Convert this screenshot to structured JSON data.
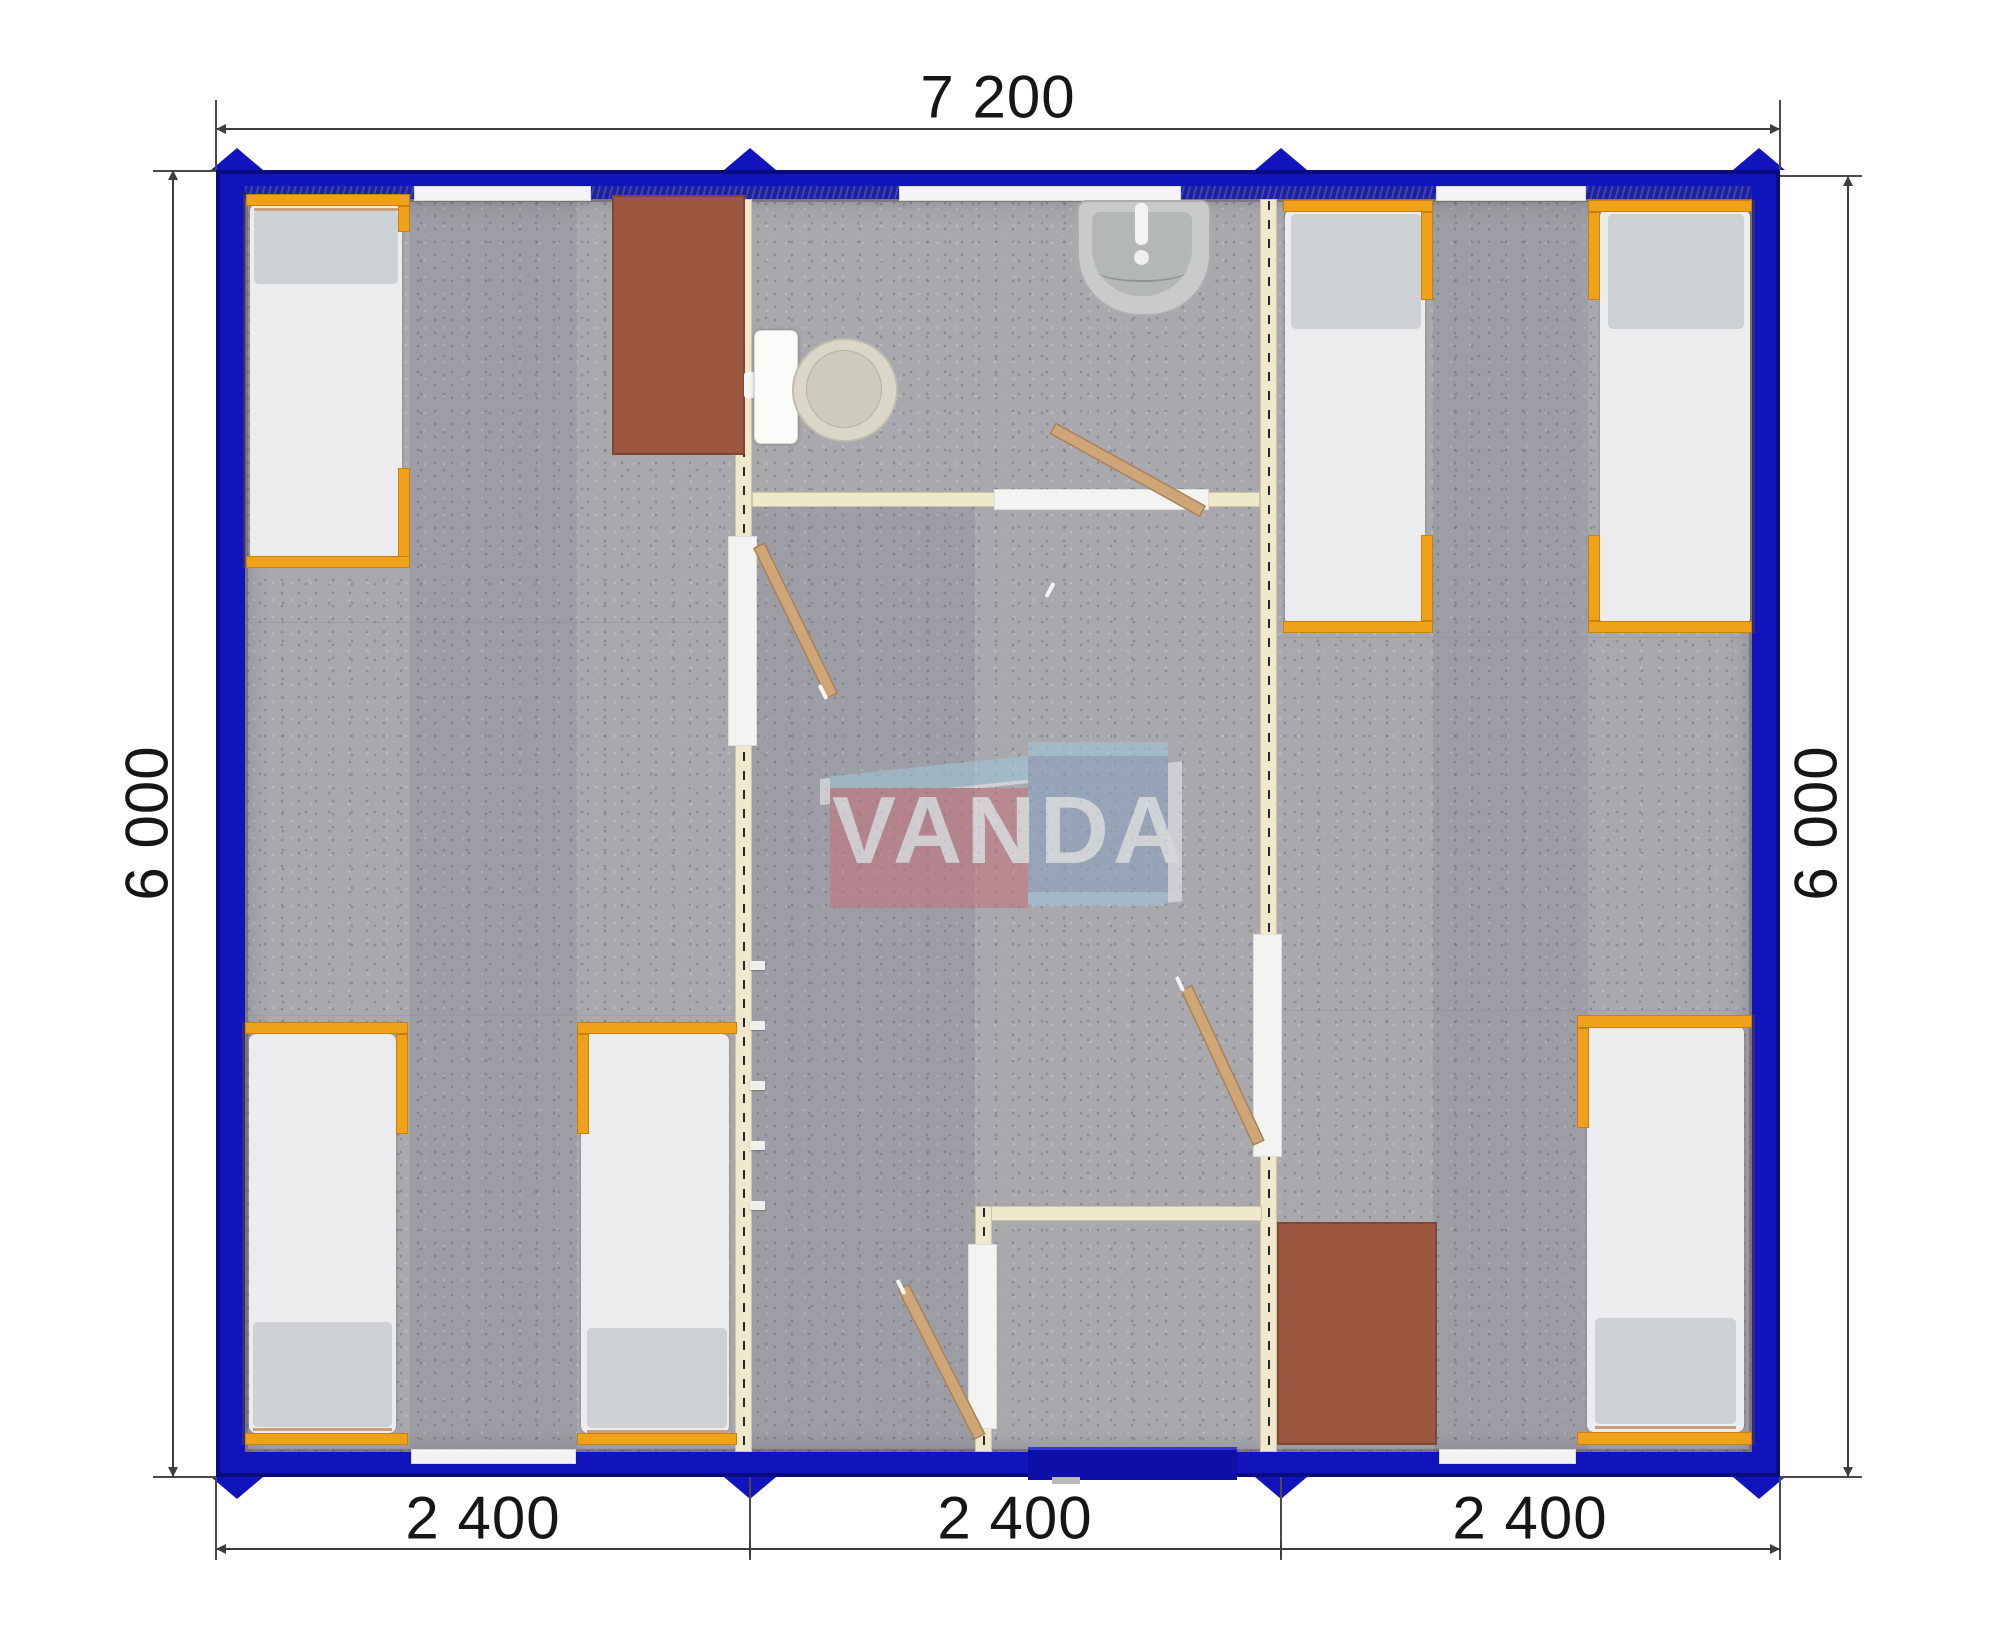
{
  "dimensions": {
    "top": "7 200",
    "left": "6 000",
    "right": "6 000",
    "bottom": [
      "2 400",
      "2 400",
      "2 400"
    ]
  },
  "logo": {
    "text": "VANDA"
  },
  "colors": {
    "wall_blue": "#1114bd",
    "wall_blue_dark": "#0a0c7e",
    "partition_cream": "#efe8cd",
    "partition_border": "#cfc5a0",
    "bed_frame_orange": "#efa11a",
    "door_wood": "#cfa678",
    "desk_brown": "#9c5740",
    "carpet_gray": "#a8a8ad",
    "mattress_white": "#eaecee",
    "pillow_gray": "#cdd1d3",
    "fixture_white": "#f7f7f5",
    "logo_red": "#c4737e",
    "logo_blue": "#8ba1bf",
    "logo_lightblue": "#a2c6da",
    "dim_text": "#161616"
  },
  "plan": {
    "overall_width_mm": "7 200",
    "overall_depth_mm": "6 000",
    "module_widths_mm": [
      "2 400",
      "2 400",
      "2 400"
    ],
    "rooms": [
      "bedroom-left",
      "bathroom",
      "hallway",
      "entry-vestibule",
      "bedroom-right"
    ],
    "furniture_counts": {
      "beds": 6,
      "desks": 2,
      "toilets": 1,
      "sinks": 1,
      "door_leaves": 4,
      "windows": 5,
      "coat_hooks": 5
    }
  }
}
